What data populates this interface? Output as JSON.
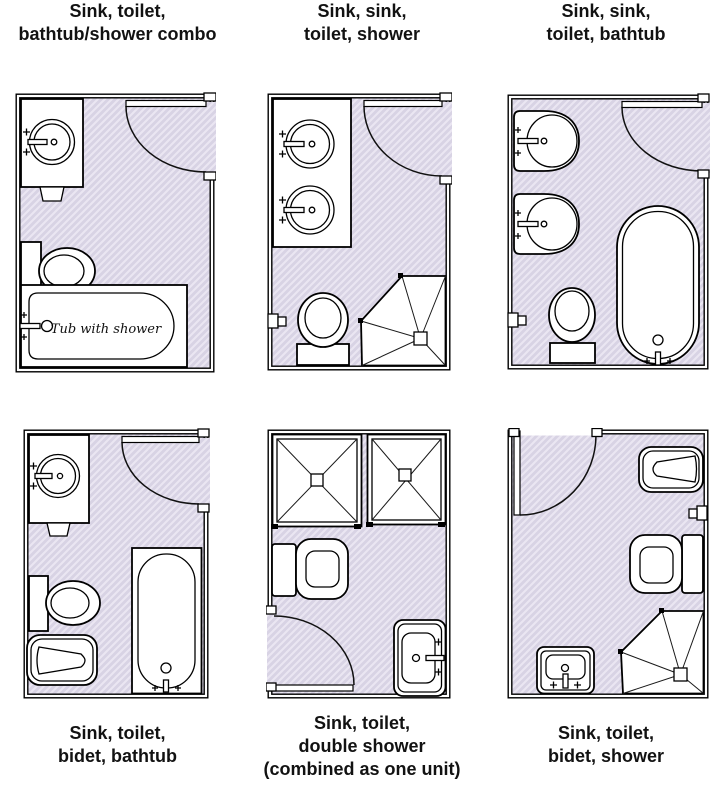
{
  "labels": {
    "top": [
      {
        "lines": [
          "Sink, toilet,",
          "bathtub/shower combo"
        ]
      },
      {
        "lines": [
          "Sink, sink,",
          "toilet, shower"
        ]
      },
      {
        "lines": [
          "Sink, sink,",
          "toilet, bathtub"
        ]
      }
    ],
    "bottom": [
      {
        "lines": [
          "Sink, toilet,",
          "bidet, bathtub"
        ]
      },
      {
        "lines": [
          "Sink, toilet,",
          "double shower",
          "(combined as one unit)"
        ]
      },
      {
        "lines": [
          "Sink, toilet,",
          "bidet, shower"
        ]
      }
    ]
  },
  "tub_label": "Tub with shower",
  "colors": {
    "floor": "#d8d3e4",
    "hatch_line": "#eae6f2",
    "outline": "#000000",
    "background": "#ffffff",
    "label_text": "#121212"
  }
}
